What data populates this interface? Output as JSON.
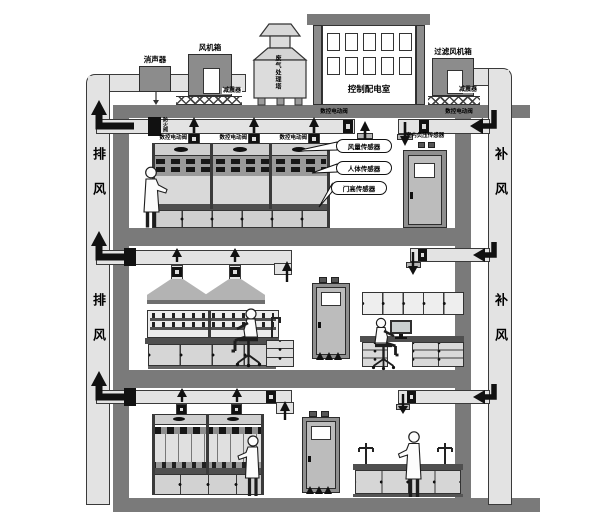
{
  "rooftop": {
    "silencer": "消声器",
    "fan_box": "风机箱",
    "tower": "废气处理塔",
    "control_room": "控制配电室",
    "filter_fan_box": "过滤风机箱",
    "damper_left": "减震器",
    "damper_right": "减震器"
  },
  "shafts": {
    "exhaust_upper": "排风",
    "exhaust_lower": "排风",
    "supply_upper": "补风",
    "supply_lower": "补风"
  },
  "floor1": {
    "fire_damper": "防火阀",
    "hood_valves": [
      "数控电动阀",
      "数控电动阀",
      "数控电动阀"
    ],
    "main_exhaust_valve": "数控电动阀",
    "supply_valve": "数控电动阀",
    "callouts": [
      "风量传感器",
      "人体传感器",
      "门高传感器"
    ],
    "pressure_sensor": "室内负压传感器"
  },
  "colors": {
    "structure_gray": "#7a7a7a",
    "duct_fill": "#e3e3e3",
    "equipment_gray": "#8c8c8c",
    "dark_band": "#4f4f4f",
    "black": "#111111",
    "background": "#ffffff"
  }
}
